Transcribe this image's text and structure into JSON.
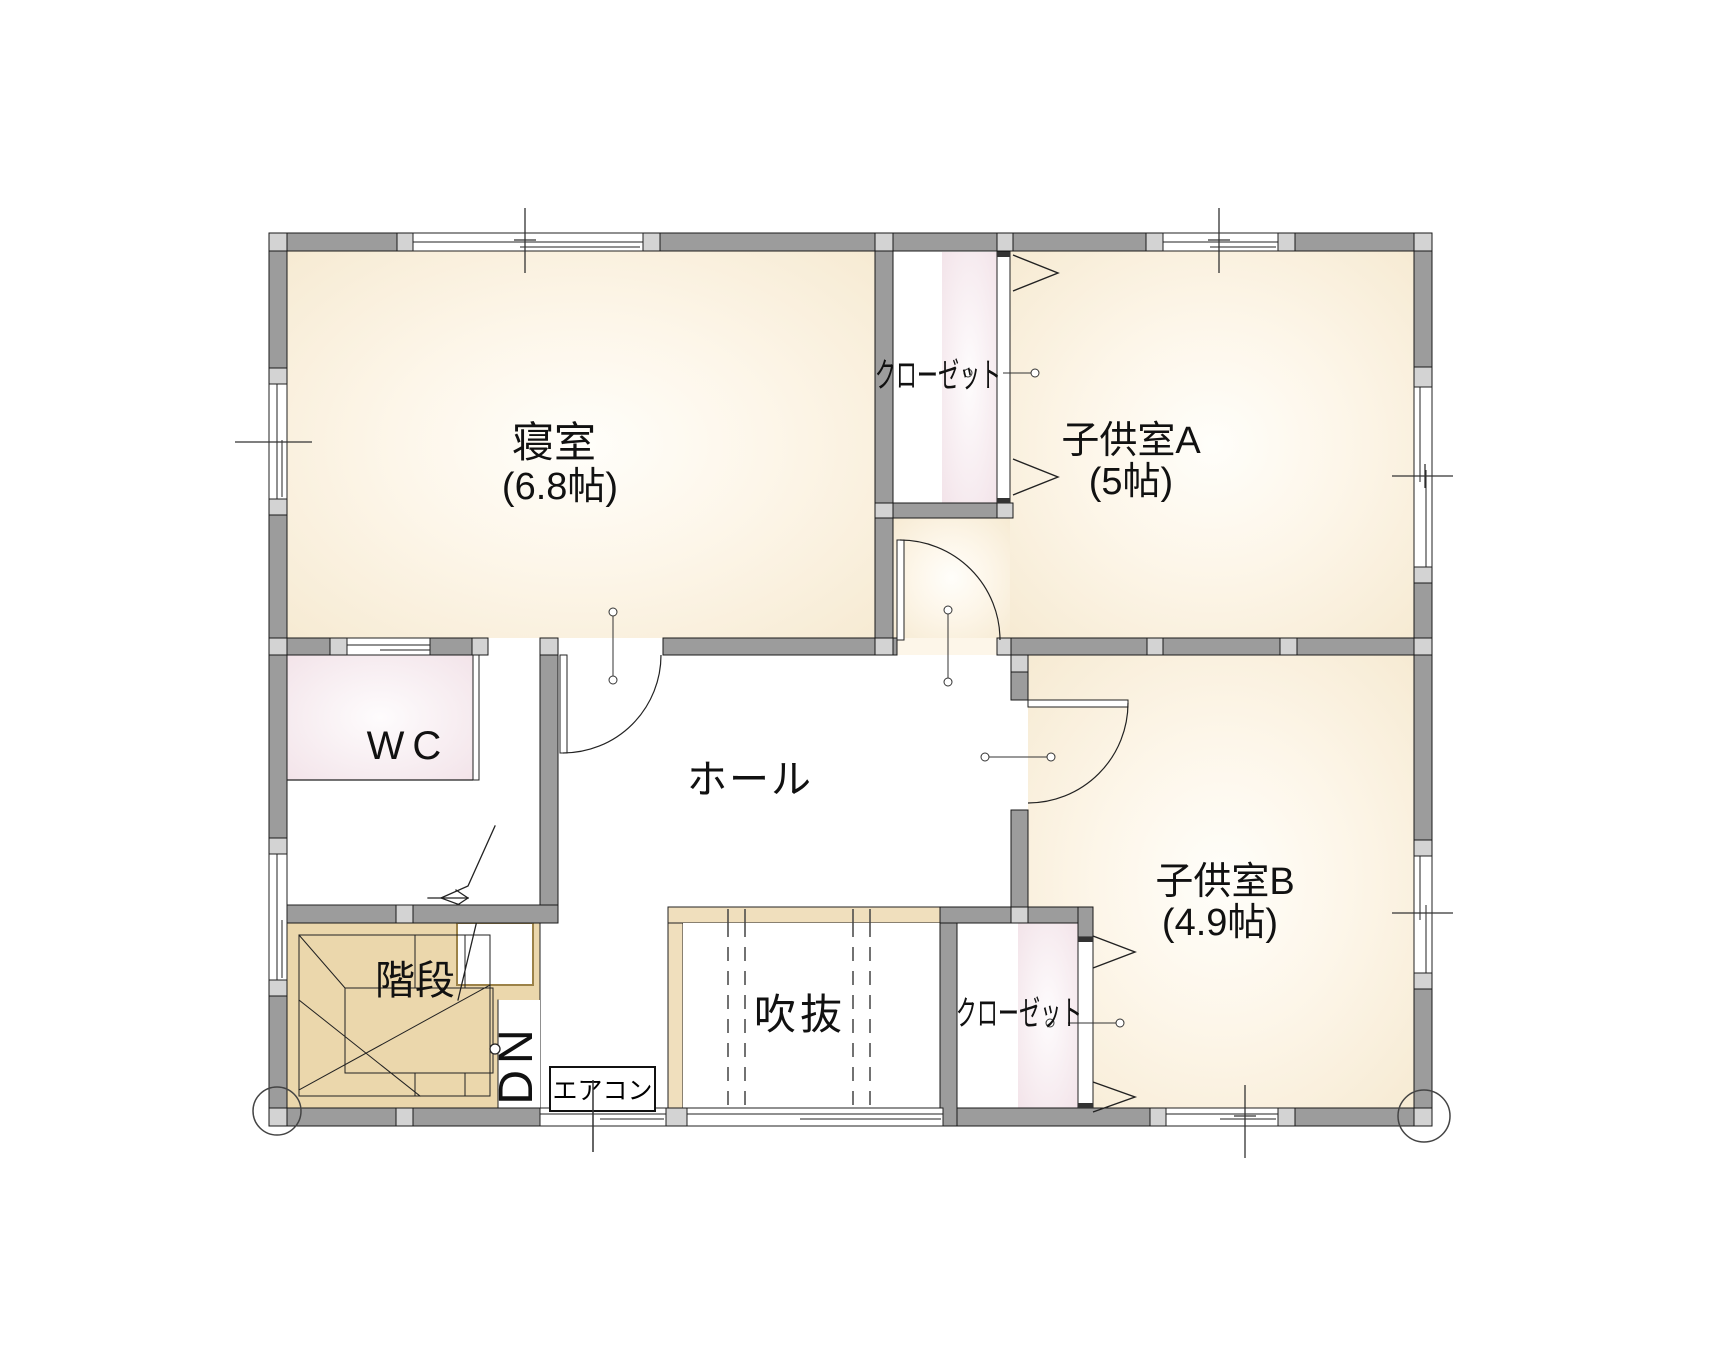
{
  "page": {
    "type": "floor-plan",
    "floor": "2F"
  },
  "rooms": {
    "bedroom": {
      "label": "寝室",
      "size": "(6.8帖)"
    },
    "child_room_a": {
      "label": "子供室A",
      "size": "(5帖)"
    },
    "child_room_b": {
      "label": "子供室B",
      "size": "(4.9帖)"
    },
    "hall": {
      "label": "ホール"
    },
    "toilet": {
      "label": "WC"
    },
    "stairs": {
      "label": "階段"
    },
    "atrium_void": {
      "label": "吹抜"
    },
    "closet_top": {
      "label": "クローゼット"
    },
    "closet_bottom": {
      "label": "クローゼット"
    }
  },
  "annotations": {
    "air_conditioner": {
      "label": "エアコン"
    },
    "down": {
      "label": "DN"
    }
  },
  "colors": {
    "wall_dark": "#9c9c9c",
    "wall_light": "#d3d3d3",
    "room_cream_edge": "#f6ead2",
    "room_pink_edge": "#f3e3e8",
    "stair_tan": "#ebd7ac",
    "handrail_tan": "#f0dfbd",
    "line": "#222222"
  }
}
